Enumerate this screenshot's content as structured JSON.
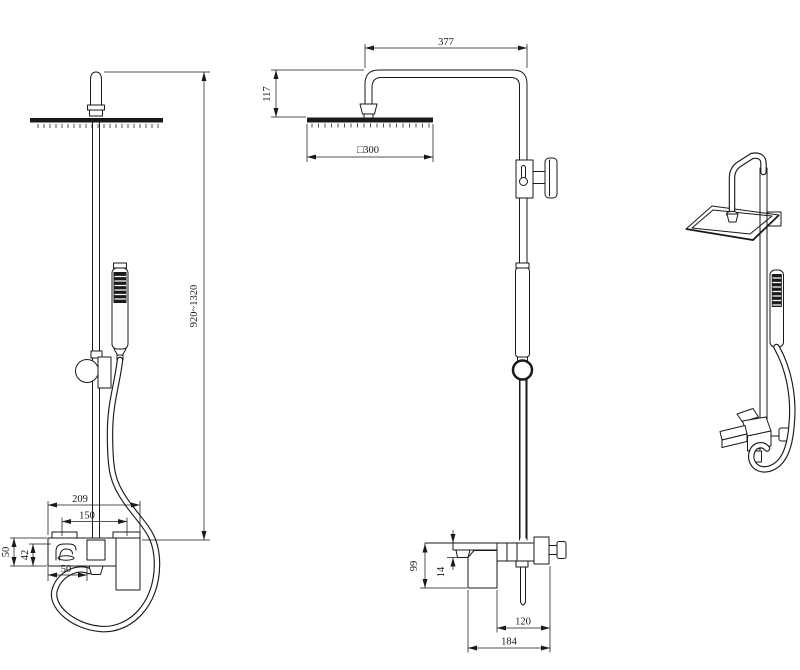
{
  "drawing": {
    "background_color": "#ffffff",
    "line_color": "#1a1a1a",
    "views": {
      "front": {
        "dims": {
          "height_range": "920~1320",
          "overall_width": "209",
          "center_width": "150",
          "body_height": "50",
          "spout_height": "42",
          "spout_offset": "50"
        }
      },
      "side": {
        "dims": {
          "arm_reach": "377",
          "head_drop": "117",
          "head_size": "□300",
          "body_height": "99",
          "spout_drop": "14",
          "wall_to_pipe": "120",
          "wall_to_handle": "184"
        }
      }
    }
  }
}
